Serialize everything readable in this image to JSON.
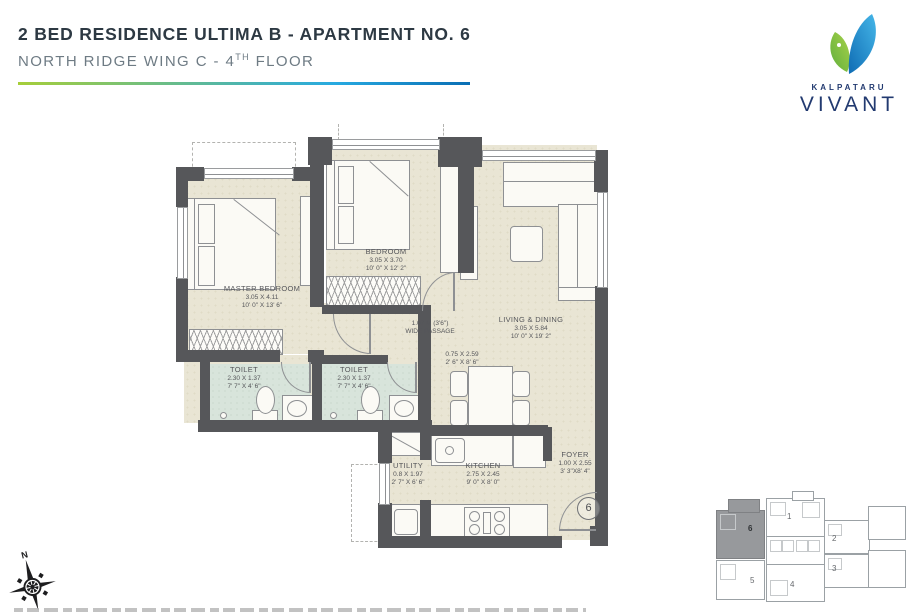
{
  "header": {
    "title": "2 BED RESIDENCE ULTIMA B - APARTMENT NO. 6",
    "subtitle_main": "NORTH RIDGE WING C - 4",
    "subtitle_sup": "TH",
    "subtitle_end": " FLOOR"
  },
  "logo": {
    "brand": "KALPATARU",
    "name": "VIVANT"
  },
  "colors": {
    "accent_gradient_start": "#a6ce39",
    "accent_gradient_end": "#0a6eb4",
    "brand_navy": "#223a70",
    "leaf_green": "#8cc63e",
    "leaf_blue": "#1b9cd8",
    "wall": "#56575a",
    "floor": "#e9e5d4",
    "toilet_floor": "#d8e4db"
  },
  "plan": {
    "unit_number": "6",
    "compass_north": "N",
    "rooms": [
      {
        "name": "MASTER BEDROOM",
        "metric": "3.05 X 4.11",
        "imperial": "10' 0\" X 13' 6\""
      },
      {
        "name": "BEDROOM",
        "metric": "3.05 X 3.70",
        "imperial": "10' 0\" X 12' 2\""
      },
      {
        "name": "LIVING & DINING",
        "metric": "3.05 X 5.84",
        "imperial": "10' 0\" X 19' 2\""
      },
      {
        "name": "TOILET",
        "metric": "2.30 X 1.37",
        "imperial": "7' 7\" X 4' 6\""
      },
      {
        "name": "TOILET",
        "metric": "2.30 X 1.37",
        "imperial": "7' 7\" X 4' 6\""
      },
      {
        "name": "UTILITY",
        "metric": "0.8 X 1.97",
        "imperial": "2' 7\" X 6' 6\""
      },
      {
        "name": "KITCHEN",
        "metric": "2.75 X 2.45",
        "imperial": "9' 0\" X 8' 0\""
      },
      {
        "name": "FOYER",
        "metric": "1.00 X 2.55",
        "imperial": "3' 3\"X8' 4\""
      }
    ],
    "passage": {
      "line1": "1.07 M (3'6\")",
      "line2": "WIDE PASSAGE"
    },
    "strip_dim": {
      "line1": "0.75 X 2.59",
      "line2": "2' 6\" X 8' 6\""
    }
  },
  "key_plan": {
    "units": [
      "1",
      "2",
      "3",
      "4",
      "5",
      "6"
    ],
    "highlighted": "6"
  }
}
